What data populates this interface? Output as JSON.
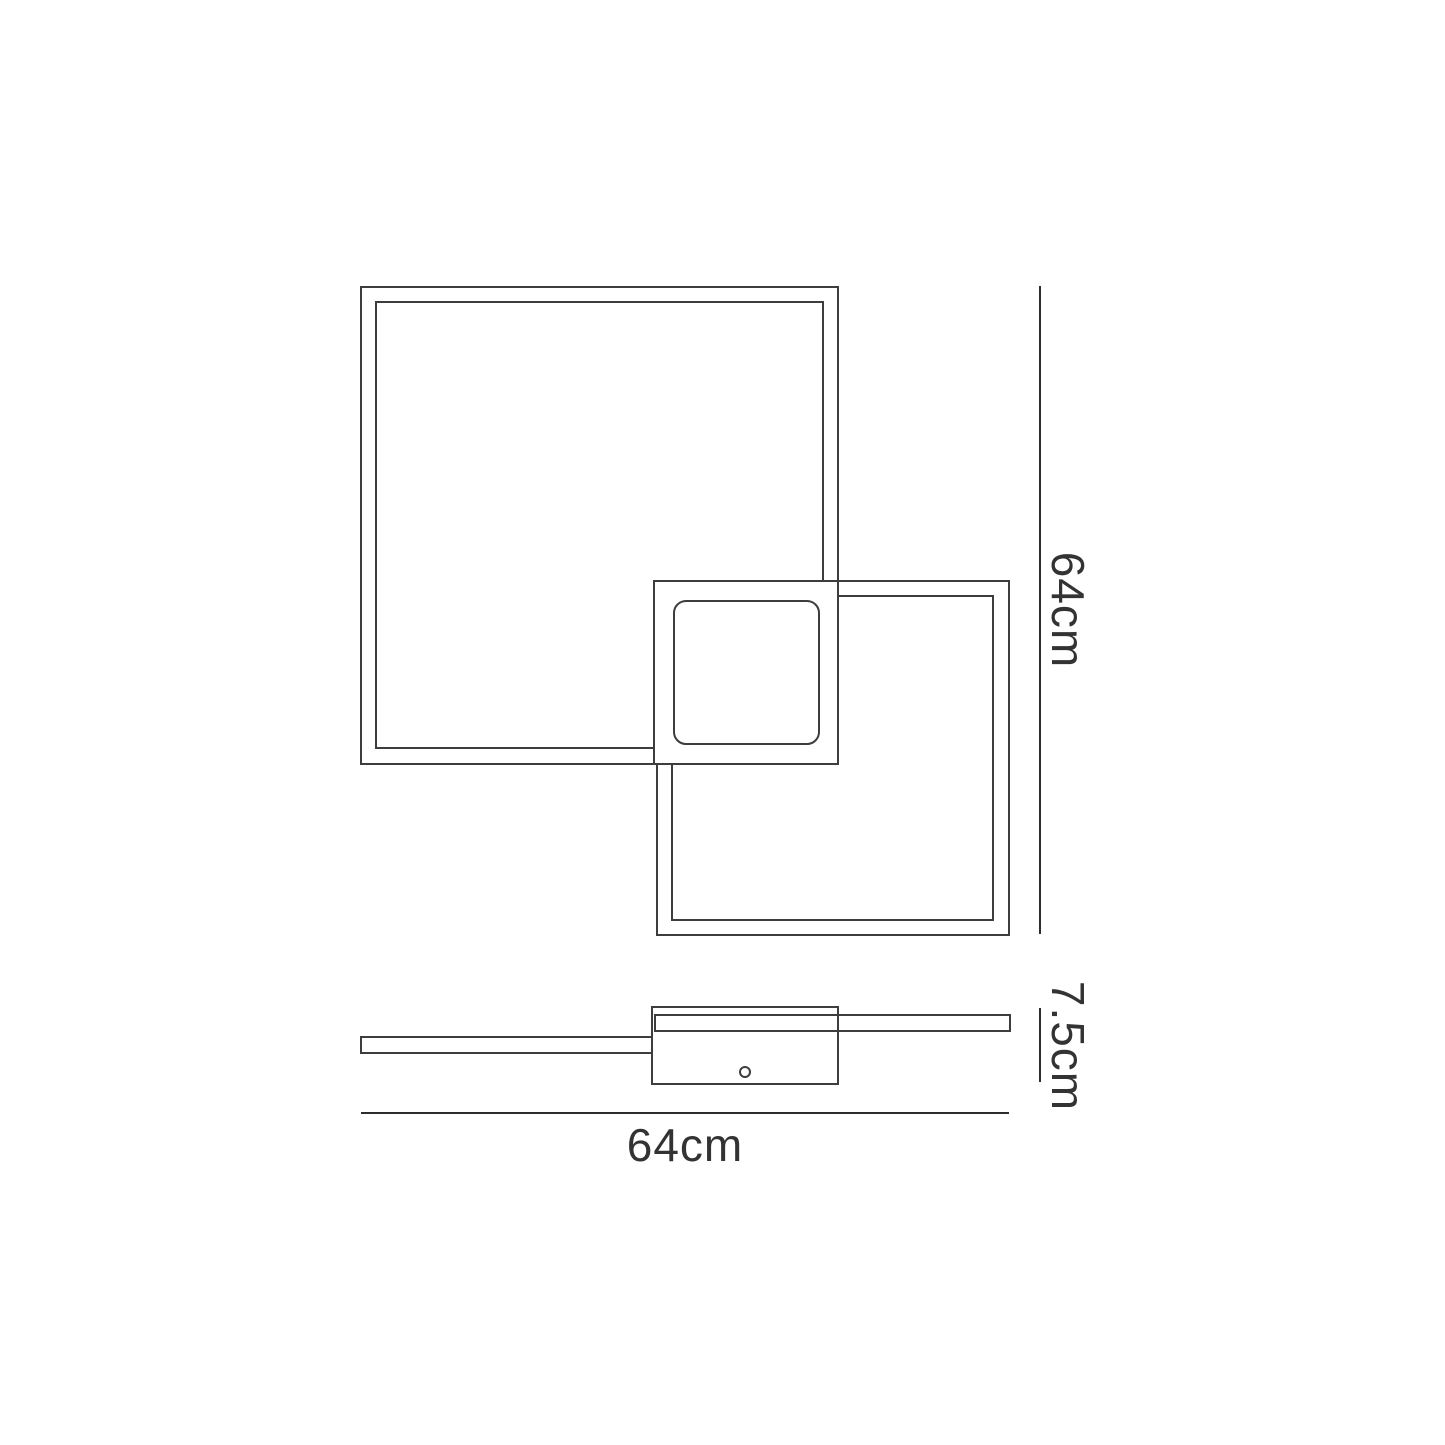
{
  "diagram": {
    "colors": {
      "background": "#ffffff",
      "stroke": "#3d3d3d",
      "dimension_lines": "#2d2d2d",
      "text": "#333333"
    },
    "dimensions": {
      "height": {
        "label": "64cm"
      },
      "depth": {
        "label": "7.5cm"
      },
      "width": {
        "label": "64cm"
      }
    }
  }
}
